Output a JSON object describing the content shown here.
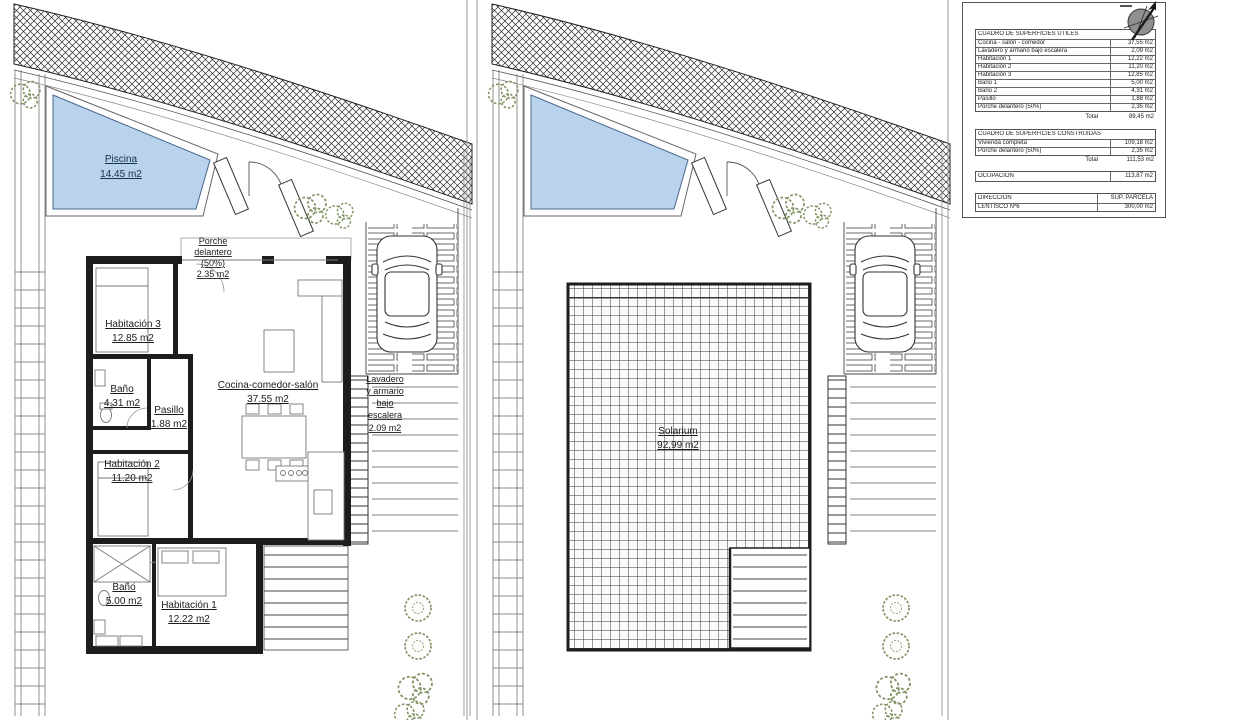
{
  "plan_left": {
    "piscina": [
      "Piscina",
      "14.45 m2"
    ],
    "porche": [
      "Porche",
      "delantero",
      "(50%)",
      "2.35 m2"
    ],
    "habitacion3": [
      "Habitación 3",
      "12.85 m2"
    ],
    "bano2": [
      "Baño",
      "4.31 m2"
    ],
    "pasillo": [
      "Pasillo",
      "1.88 m2"
    ],
    "cocina": [
      "Cocina-comedor-salón",
      "37.55 m2"
    ],
    "lavadero": [
      "Lavadero",
      "y armario",
      "bajo",
      "escalera",
      "2.09 m2"
    ],
    "habitacion2": [
      "Habitación 2",
      "11.20 m2"
    ],
    "bano1": [
      "Baño",
      "5.00 m2"
    ],
    "habitacion1": [
      "Habitación 1",
      "12.22 m2"
    ]
  },
  "plan_right": {
    "solarium": [
      "Solarium",
      "92,99 m2"
    ]
  },
  "tables": {
    "utiles": {
      "title": "CUADRO DE SUPERFICIES ÚTILES",
      "rows": [
        {
          "label": "Cocina - salón - comedor",
          "value": "37,55 m2"
        },
        {
          "label": "Lavadero y armario bajo escalera",
          "value": "2,09 m2"
        },
        {
          "label": "Habitación 1",
          "value": "12,22 m2"
        },
        {
          "label": "Habitación 2",
          "value": "11,20 m2"
        },
        {
          "label": "Habitación 3",
          "value": "12,85 m2"
        },
        {
          "label": "Baño 1",
          "value": "5,00 m2"
        },
        {
          "label": "Baño 2",
          "value": "4,31 m2"
        },
        {
          "label": "Pasillo",
          "value": "1,88 m2"
        },
        {
          "label": "Porche delantero (50%)",
          "value": "2,35 m2"
        }
      ],
      "total_label": "Total",
      "total_value": "89,45 m2"
    },
    "construidas": {
      "title": "CUADRO DE SUPERFICIES CONSTRUIDAS",
      "rows": [
        {
          "label": "Vivienda completa",
          "value": "109,18 m2"
        },
        {
          "label": "Porche delantero (50%)",
          "value": "2,35 m2"
        }
      ],
      "total_label": "Total",
      "total_value": "111,53 m2"
    },
    "ocupacion": {
      "label": "OCUPACIÓN",
      "value": "113,87 m2"
    },
    "direccion": {
      "header_label": "DIRECCIÓN",
      "header_value": "SUP. PARCELA",
      "row_label": "LENTISCO Nº6",
      "row_value": "300,00 m2"
    }
  },
  "colors": {
    "pool": "#bad3ec",
    "plant": "#7e9160",
    "wall": "#1d1d1d"
  }
}
